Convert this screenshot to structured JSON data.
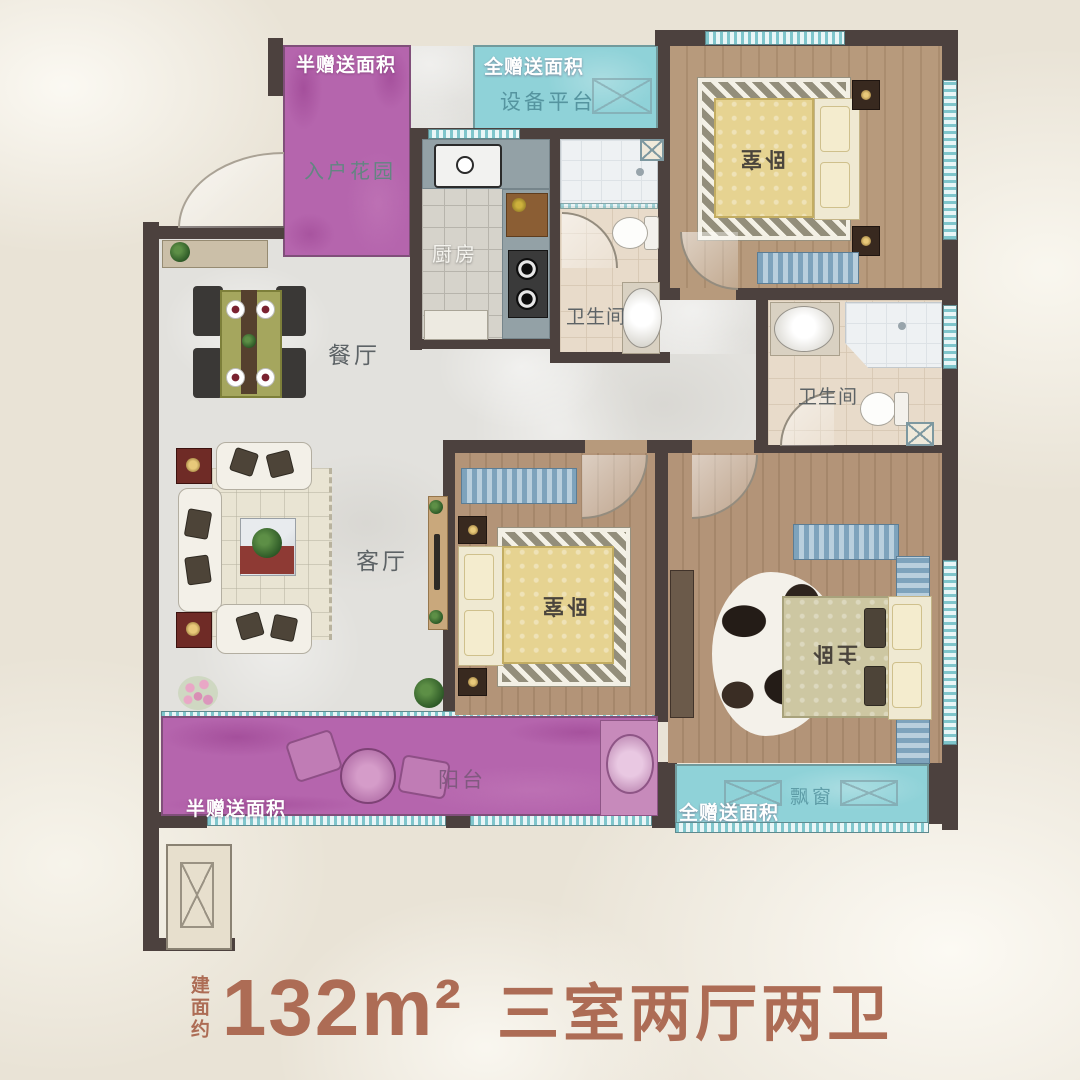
{
  "caption": {
    "prefix": "建面约",
    "area": "132m²",
    "layout": "三室两厅两卫"
  },
  "plan": {
    "gift_labels": {
      "top_left": "半赠送面积",
      "top_center": "全赠送面积",
      "bottom_left": "半赠送面积",
      "bottom_right": "全赠送面积"
    },
    "rooms": {
      "entrance_garden": "入户花园",
      "equipment_platform": "设备平台",
      "bedroom_top": "卧室",
      "kitchen": "厨房",
      "bathroom_top": "卫生间",
      "bathroom_right": "卫生间",
      "dining_room": "餐厅",
      "living_room": "客厅",
      "bedroom_middle": "卧室",
      "master_bedroom": "主卧",
      "balcony": "阳台",
      "bay_window": "飘窗"
    },
    "colors": {
      "wall": "#4c413e",
      "gift_purple": "#b565ad",
      "gift_cyan": "#8fd2d8",
      "wood_floor": "#b79a7c",
      "marble_floor": "#e2e1dd",
      "caption_text": "#ad6c55",
      "label_white": "#ffffff"
    }
  }
}
